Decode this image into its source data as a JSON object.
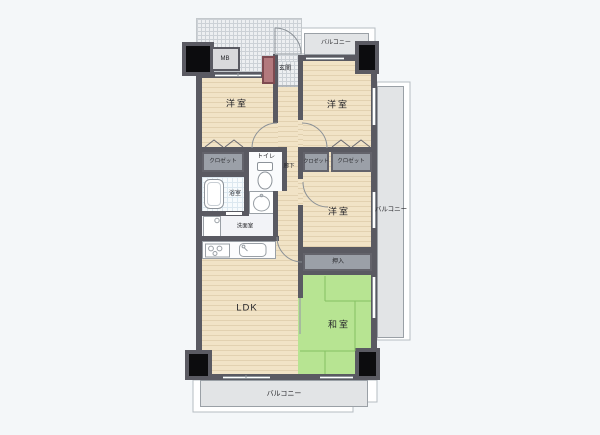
{
  "labels": {
    "room_west_top_left": "洋室",
    "room_west_top_right": "洋室",
    "room_west_middle": "洋室",
    "room_japanese": "和室",
    "ldk": "LDK",
    "hallway": "廊下",
    "entrance": "玄関",
    "toilet": "トイレ",
    "bathroom": "浴室",
    "washroom": "洗面室",
    "closet_left": "クロゼット",
    "closet_middle": "クロゼット",
    "closet_right": "クロゼット",
    "futon_closet": "押入",
    "meter_box": "MB",
    "balcony_top": "バルコニー",
    "balcony_right": "バルコニー",
    "balcony_bottom": "バルコニー"
  },
  "colors": {
    "wall": "#5a5a62",
    "wood_floor": "#f1e3c6",
    "wood_stripe": "#e2d1b0",
    "tatami_green": "#b7e492",
    "tatami_line": "#84c162",
    "balcony_gray": "#e2e4e6",
    "closet_gray": "#9ba0a8",
    "shoe_cabinet_red": "#b3797d",
    "pillar_black": "#0c0c0e",
    "entrance_tile": "#edeff1"
  }
}
